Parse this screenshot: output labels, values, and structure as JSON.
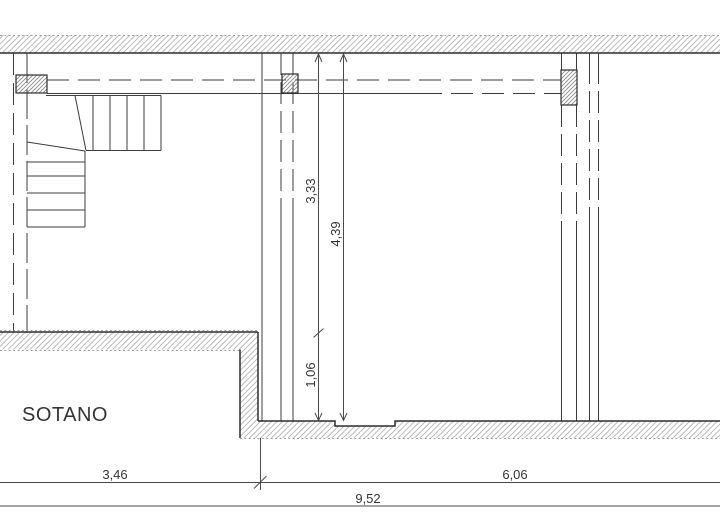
{
  "plan": {
    "room_label": "SOTANO",
    "dims": {
      "v_upper": "3,33",
      "v_total": "4,39",
      "v_lower": "1,06",
      "h_left": "3,46",
      "h_right": "6,06",
      "h_total": "9,52"
    }
  },
  "colors": {
    "background": "#ffffff",
    "line": "#3d3d3d",
    "wall-edge": "#2d2d2d",
    "hatch": "#b4b4b4",
    "column-hatch": "#8a8a8a",
    "dotted": "#9b9b9b",
    "text": "#343434"
  }
}
